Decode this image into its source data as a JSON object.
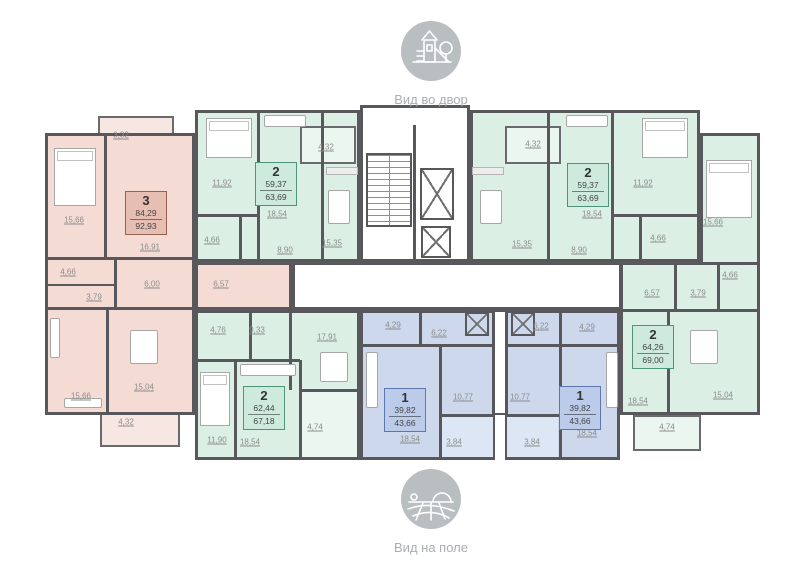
{
  "views": {
    "top": {
      "label": "Вид во двор",
      "icon": "playground-icon"
    },
    "bottom": {
      "label": "Вид на поле",
      "icon": "field-icon"
    }
  },
  "apartments": [
    {
      "rooms": "3",
      "area_living": "84,29",
      "area_total": "92,93"
    },
    {
      "rooms": "2",
      "area_living": "59,37",
      "area_total": "63,69"
    },
    {
      "rooms": "2",
      "area_living": "59,37",
      "area_total": "63,69"
    },
    {
      "rooms": "2",
      "area_living": "64,26",
      "area_total": "69,00"
    },
    {
      "rooms": "2",
      "area_living": "62,44",
      "area_total": "67,18"
    },
    {
      "rooms": "1",
      "area_living": "39,82",
      "area_total": "43,66"
    },
    {
      "rooms": "1",
      "area_living": "39,82",
      "area_total": "43,66"
    }
  ],
  "room_areas": [
    {
      "v": "3,32"
    },
    {
      "v": "15,66"
    },
    {
      "v": "16,91"
    },
    {
      "v": "4,66"
    },
    {
      "v": "3,79"
    },
    {
      "v": "6,00"
    },
    {
      "v": "6,57"
    },
    {
      "v": "15,66"
    },
    {
      "v": "15,04"
    },
    {
      "v": "4,32"
    },
    {
      "v": "11,92"
    },
    {
      "v": "4,32"
    },
    {
      "v": "18,54"
    },
    {
      "v": "4,66"
    },
    {
      "v": "8,90"
    },
    {
      "v": "15,35"
    },
    {
      "v": "4,32"
    },
    {
      "v": "18,54"
    },
    {
      "v": "11,92"
    },
    {
      "v": "15,35"
    },
    {
      "v": "8,90"
    },
    {
      "v": "4,66"
    },
    {
      "v": "15,66"
    },
    {
      "v": "4,66"
    },
    {
      "v": "6,57"
    },
    {
      "v": "3,79"
    },
    {
      "v": "18,54"
    },
    {
      "v": "15,04"
    },
    {
      "v": "4,74"
    },
    {
      "v": "4,76"
    },
    {
      "v": "9,33"
    },
    {
      "v": "17,91"
    },
    {
      "v": "11,90"
    },
    {
      "v": "18,54"
    },
    {
      "v": "4,74"
    },
    {
      "v": "4,29"
    },
    {
      "v": "6,22"
    },
    {
      "v": "10,77"
    },
    {
      "v": "18,54"
    },
    {
      "v": "3,84"
    },
    {
      "v": "6,22"
    },
    {
      "v": "4,29"
    },
    {
      "v": "10,77"
    },
    {
      "v": "18,54"
    },
    {
      "v": "3,84"
    }
  ],
  "colors": {
    "apartment_3_room": "#f4dcd5",
    "apartment_2_room": "#dcefe4",
    "apartment_1_room": "#cdd8ed",
    "walls": "#58585c",
    "icon_gray": "#b9bec1"
  }
}
